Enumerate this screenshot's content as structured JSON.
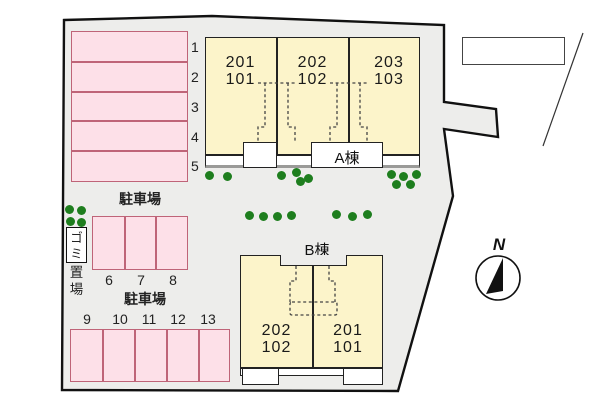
{
  "plan": {
    "compass": {
      "label": "N"
    },
    "parking": {
      "lot1": {
        "label": "駐車場",
        "spaces": [
          "1",
          "2",
          "3",
          "4",
          "5"
        ]
      },
      "lot2": {
        "spaces": [
          "6",
          "7",
          "8"
        ]
      },
      "lot3": {
        "label": "駐車場",
        "spaces": [
          "9",
          "10",
          "11",
          "12",
          "13"
        ]
      }
    },
    "garbage": {
      "label_top": "ゴミ",
      "label_bottom": "置場"
    },
    "building_a": {
      "name": "A棟",
      "units": [
        {
          "upper": "201",
          "lower": "101"
        },
        {
          "upper": "202",
          "lower": "102"
        },
        {
          "upper": "203",
          "lower": "103"
        }
      ]
    },
    "building_b": {
      "name": "B棟",
      "units": [
        {
          "upper": "202",
          "lower": "102"
        },
        {
          "upper": "201",
          "lower": "101"
        }
      ]
    },
    "colors": {
      "site_fill": "#ededeb",
      "building_fill": "#fcf4ca",
      "parking_fill": "#fde0e8",
      "parking_border": "#bf6478",
      "tree_green": "#1e7e1e",
      "outline": "#111111"
    }
  }
}
